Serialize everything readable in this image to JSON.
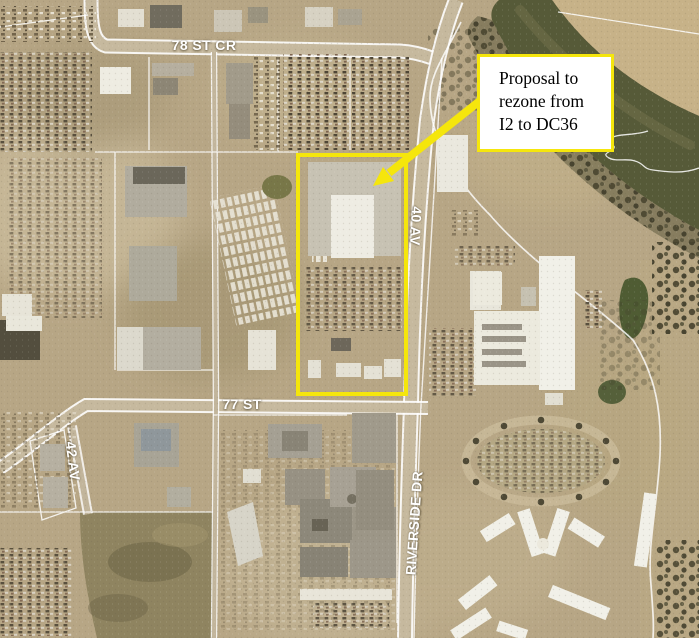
{
  "map": {
    "street_labels": [
      {
        "id": "78-st-cr",
        "text": "78 ST CR"
      },
      {
        "id": "77-st",
        "text": "77 ST"
      },
      {
        "id": "40-av",
        "text": "40 AV"
      },
      {
        "id": "42-av",
        "text": "42 AV"
      },
      {
        "id": "riverside-dr",
        "text": "RIVERSIDE DR"
      }
    ],
    "callout": {
      "full_text": "Proposal to rezone from I2 to DC36",
      "lines": [
        "Proposal to",
        "rezone from",
        "I2 to DC36"
      ]
    },
    "colors": {
      "annotation_yellow": "#f5e60c",
      "street_label": "#ffffff",
      "callout_background": "#ffffff",
      "callout_text": "#000000",
      "river_water": "#565a38",
      "ground_tan": "#b7a685"
    }
  }
}
